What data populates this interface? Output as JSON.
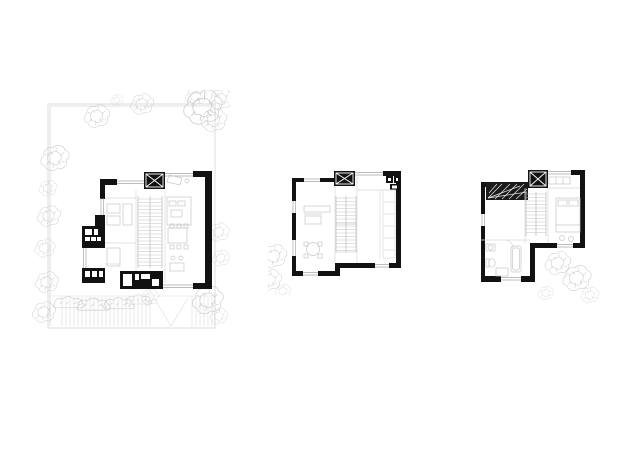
{
  "canvas": {
    "width_px": 640,
    "height_px": 452,
    "background": "#ffffff"
  },
  "palette": {
    "bg": "#ffffff",
    "wall": "#121212",
    "glazing": "#a6a6a6",
    "partition": "#d9d9d9",
    "furniture": "#c7c7c7",
    "stair": "#c3c3c3",
    "stair_rail": "#aeaeae",
    "site": "#d6d6d6",
    "vegetation": "#c5c5c5",
    "paving": "#dddddd",
    "hatch": "#1a1a1a",
    "white": "#ffffff"
  },
  "sheets": [
    {
      "id": "site-ground-floor-plan",
      "position": "left",
      "features": [
        "site-boundary",
        "garden-trees",
        "court-paving",
        "central-stair",
        "core-square-x",
        "black-kitchen-core",
        "living-dining-furniture"
      ]
    },
    {
      "id": "middle-floor-plan",
      "position": "center",
      "features": [
        "central-stair",
        "core-square-x",
        "kitchen-counter",
        "sofa",
        "round-dining-table",
        "garden-trees-outside"
      ]
    },
    {
      "id": "upper-floor-plan",
      "position": "right",
      "features": [
        "central-stair",
        "core-square-x",
        "dark-hatched-roof-area",
        "bed-with-pillows",
        "bathroom-fixtures",
        "palm-planting-outside"
      ]
    }
  ]
}
